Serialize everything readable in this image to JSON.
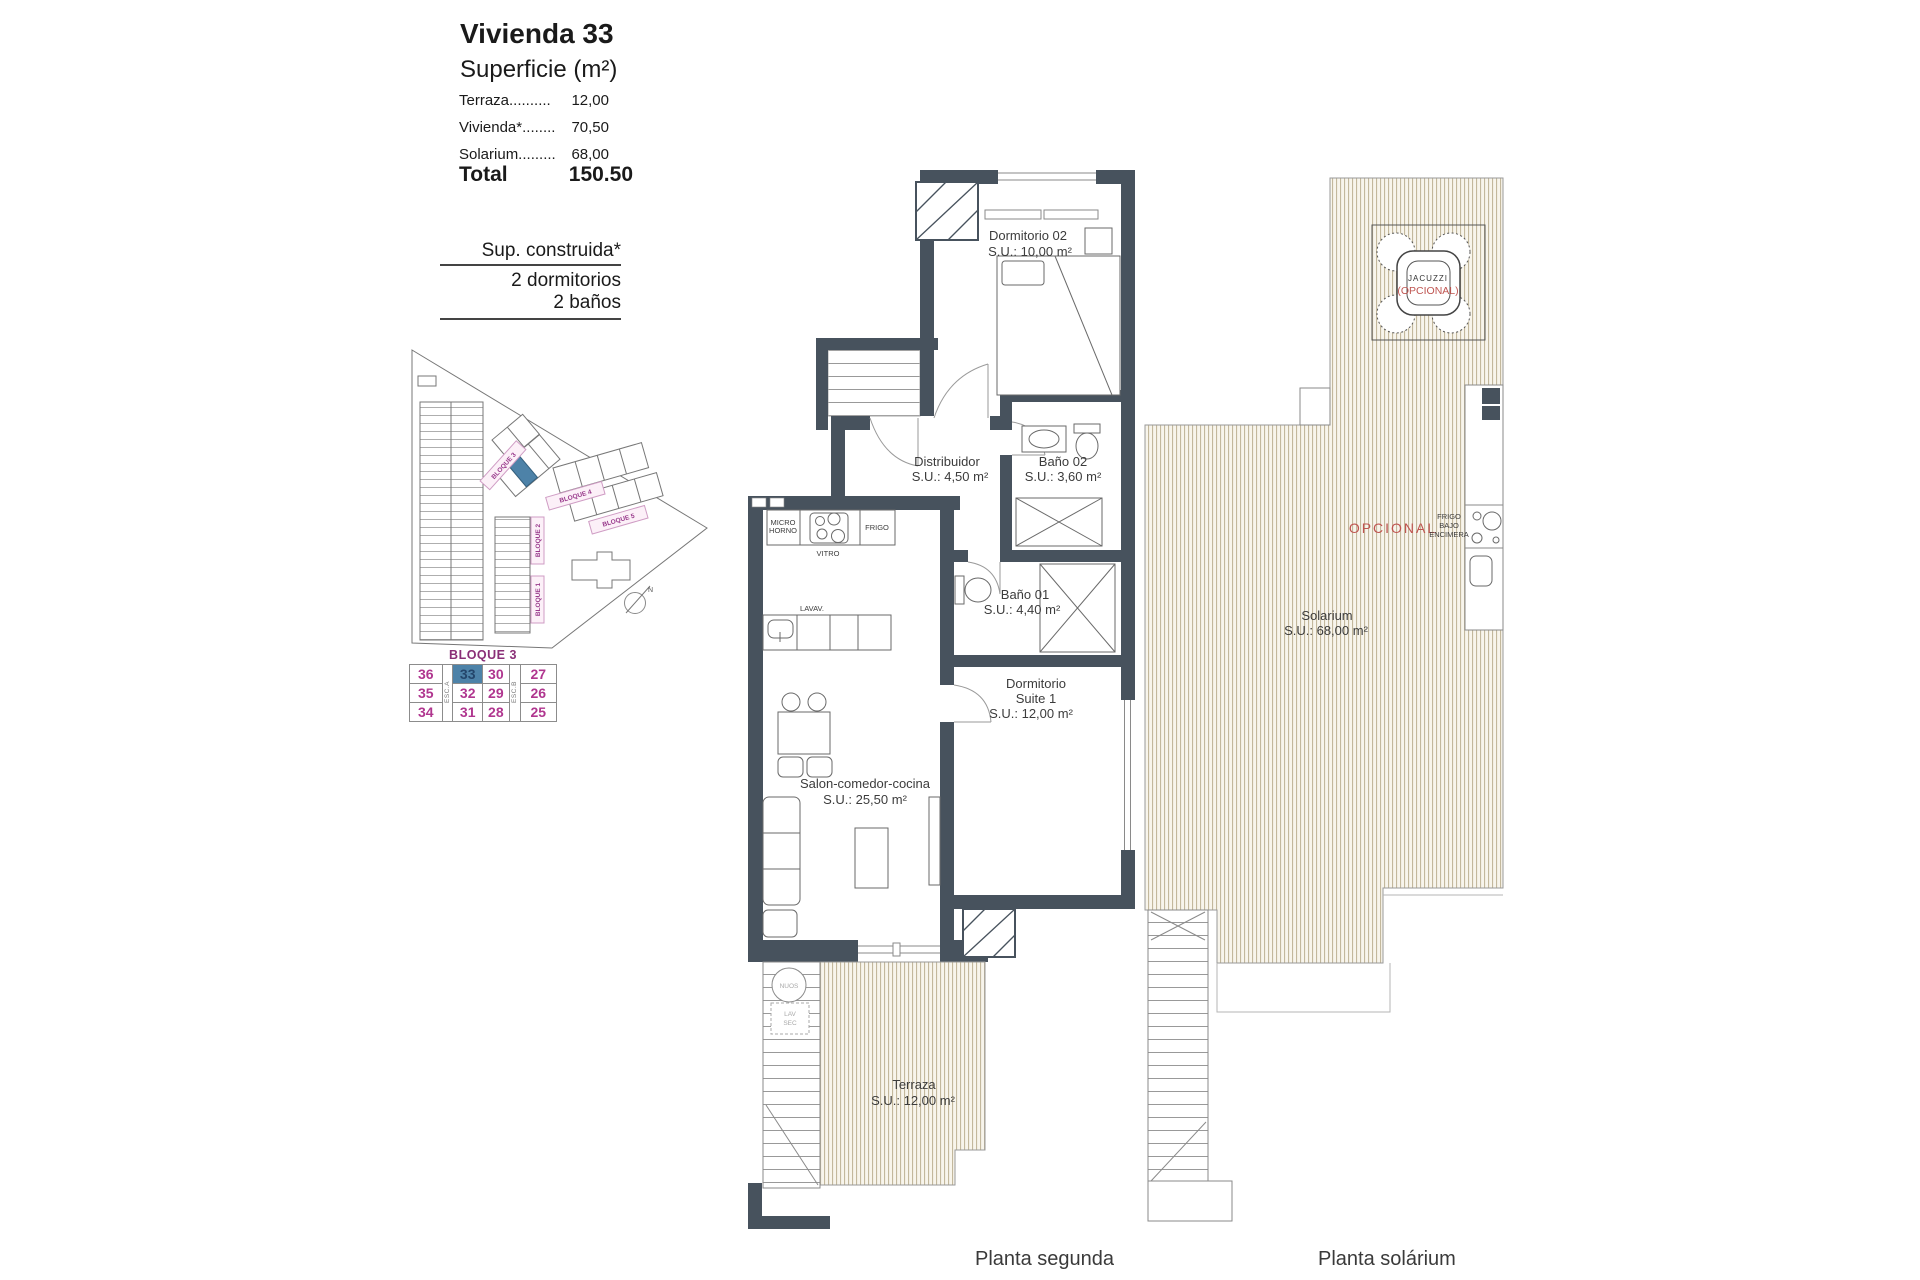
{
  "header": {
    "title": "Vivienda 33",
    "subtitle": "Superficie (m²)",
    "area_rows": [
      {
        "label": "Terraza..........",
        "value": "12,00"
      },
      {
        "label": "Vivienda*........",
        "value": "70,50"
      },
      {
        "label": "Solarium.........",
        "value": "68,00"
      }
    ],
    "total_label": "Total",
    "total_value": "150.50"
  },
  "spec": {
    "construida": "Sup. construida*",
    "dormitorios": "2 dormitorios",
    "banos": "2 baños"
  },
  "site_plan": {
    "bloque1": "BLOQUE 1",
    "bloque2": "BLOQUE 2",
    "bloque3": "BLOQUE 3",
    "bloque4": "BLOQUE 4",
    "bloque5": "BLOQUE 5",
    "north": "N"
  },
  "block_table": {
    "title": "BLOQUE 3",
    "esc_a": "ESC.A",
    "esc_b": "ESC.B",
    "rows": [
      [
        "36",
        "33",
        "30",
        "27"
      ],
      [
        "35",
        "32",
        "29",
        "26"
      ],
      [
        "34",
        "31",
        "28",
        "25"
      ]
    ],
    "highlighted_unit": "33"
  },
  "planta_segunda": {
    "caption": "Planta segunda",
    "dorm02_name": "Dormitorio 02",
    "dorm02_area": "S.U.: 10,00 m²",
    "distribuidor_name": "Distribuidor",
    "distribuidor_area": "S.U.: 4,50 m²",
    "bano02_name": "Baño 02",
    "bano02_area": "S.U.: 3,60 m²",
    "bano01_name": "Baño 01",
    "bano01_area": "S.U.: 4,40 m²",
    "suite_name1": "Dormitorio",
    "suite_name2": "Suite 1",
    "suite_area": "S.U.: 12,00 m²",
    "salon_name": "Salon-comedor-cocina",
    "salon_area": "S.U.: 25,50 m²",
    "terraza_name": "Terraza",
    "terraza_area": "S.U.: 12,00 m²",
    "micro1": "MICRO",
    "micro2": "HORNO",
    "vitro": "VITRO",
    "frigo": "FRIGO",
    "lavav": "LAVAV.",
    "nuos": "NUOS",
    "lav": "LAV",
    "sec": "SEC"
  },
  "planta_solarium": {
    "caption": "Planta solárium",
    "solarium_name": "Solarium",
    "solarium_area": "S.U.: 68,00 m²",
    "opcional": "OPCIONAL",
    "jacuzzi_line1": "JACUZZI",
    "jacuzzi_line2": "(OPCIONAL)",
    "frigo1": "FRIGO",
    "frigo2": "BAJO",
    "frigo3": "ENCIMERA"
  },
  "colors": {
    "wall": "#47525d",
    "highlight_blue": "#4d82a8",
    "magenta": "#b0368f",
    "opcional_red": "#bf5450",
    "deck_stripe": "#c3b89c"
  }
}
